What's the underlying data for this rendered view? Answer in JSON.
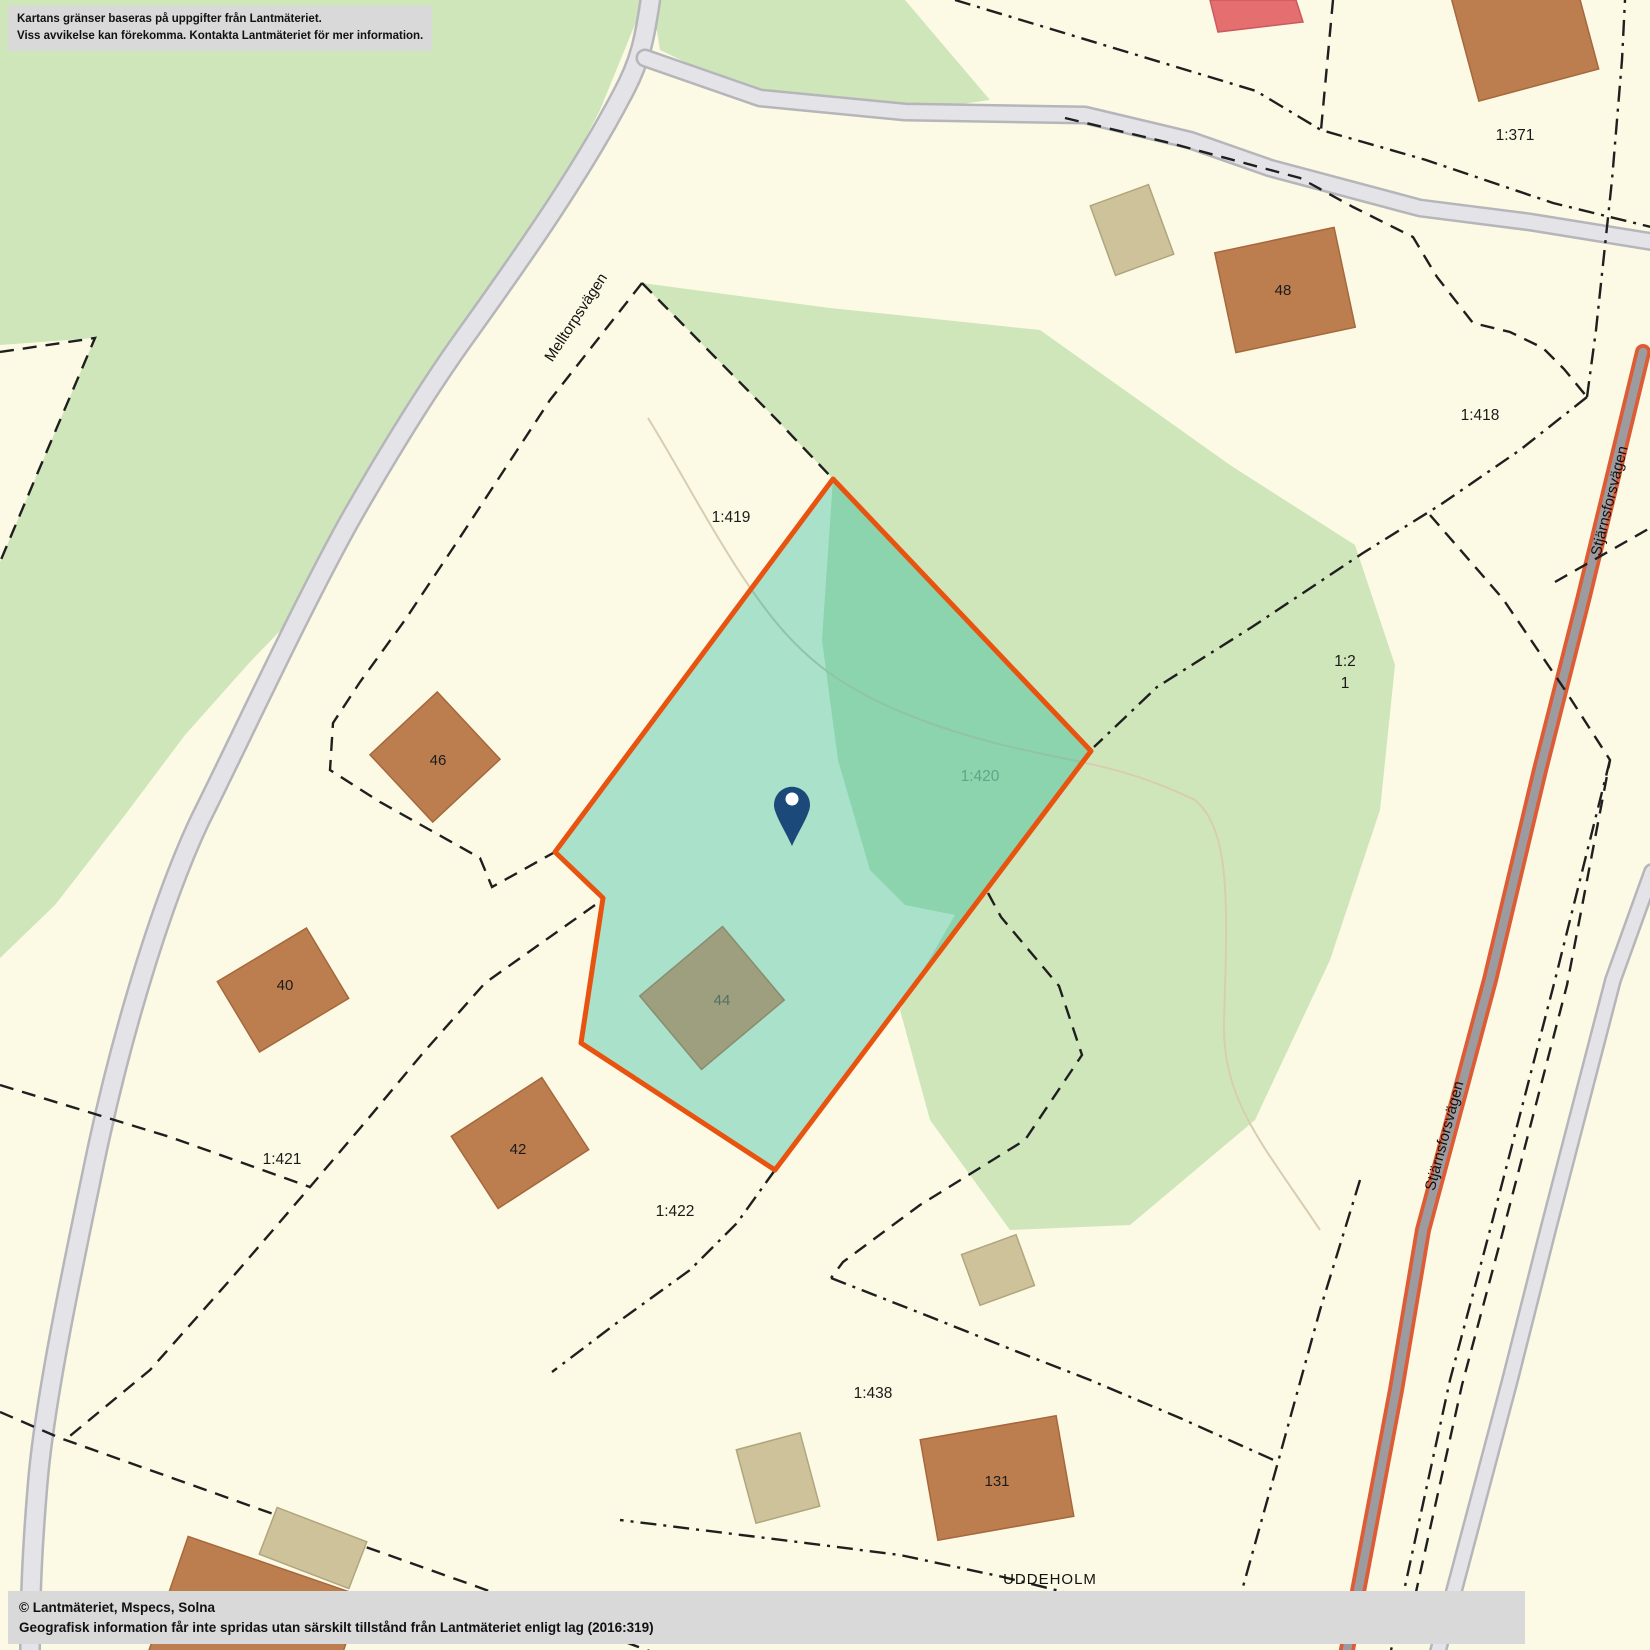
{
  "map": {
    "disclaimer": {
      "line1": "Kartans gränser baseras på uppgifter från Lantmäteriet.",
      "line2": "Viss avvikelse kan förekomma. Kontakta Lantmäteriet för mer information."
    },
    "copyright": {
      "line1": "© Lantmäteriet, Mspecs, Solna",
      "line2": "Geografisk information får inte spridas utan särskilt tillstånd från Lantmäteriet enligt lag (2016:319)"
    },
    "roads": {
      "melltorpsvagen": "Melltorpsvägen",
      "stjarnsforsvagen": "Stjärnsforsvägen"
    },
    "place": "UDDEHOLM",
    "parcels": {
      "p371": "1:371",
      "p418": "1:418",
      "p419": "1:419",
      "p420": "1:420",
      "p421": "1:421",
      "p422": "1:422",
      "p438": "1:438",
      "p2": "1:2",
      "p2_unit": "1"
    },
    "buildings": {
      "b40": "40",
      "b42": "42",
      "b44": "44",
      "b46": "46",
      "b48": "48",
      "b131": "131"
    },
    "colors": {
      "background": "#fcfae4",
      "forest": "#cfe6ba",
      "highlight_fill": "rgba(0,175,150,0.33)",
      "highlight_border": "#e95310",
      "road_fill": "#e4e4e8",
      "road_casing": "#b5b5ba",
      "main_road_accent": "#dd5b35",
      "pin": "#1b4a7a",
      "boundary": "#1f1f1f"
    }
  }
}
